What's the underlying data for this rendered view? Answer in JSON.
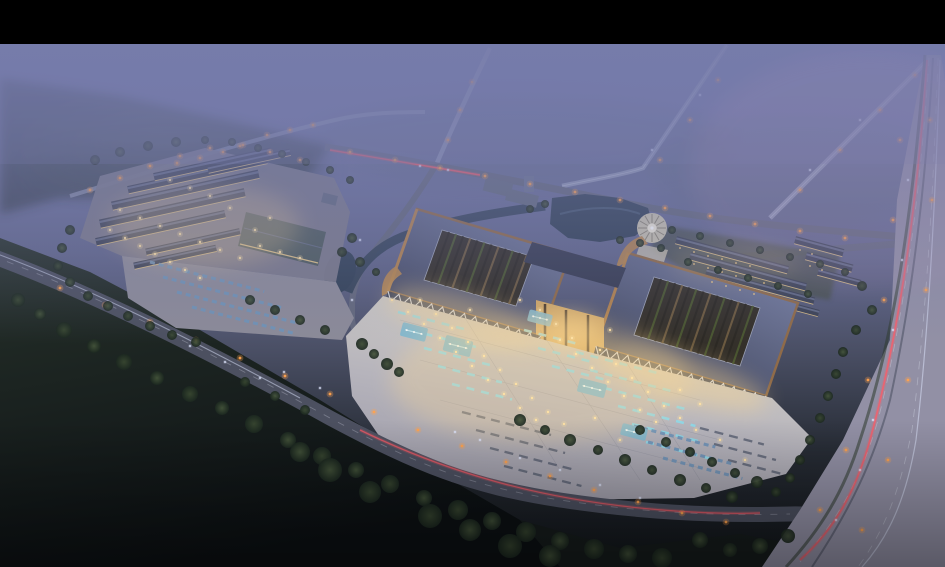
{
  "meta": {
    "alt": "Twilight aerial rendering of a lakeside commercial complex: two grand curved-roof halls with open courtyards, an illuminated forecourt plaza with cyan-lit lanes and fountain pools, a secondary market complex with parking, ponds, a circular plaza, rows of low buildings, tree lines, and roads with car light trails fading into purple mist.",
    "canvas": {
      "w": 945,
      "h": 567
    },
    "letterbox_top": 44
  },
  "colors": {
    "black_bar": "#000000",
    "sky_top": "#7379a9",
    "sky_upper": "#6f74a0",
    "sky_mid": "#61668a",
    "ground_mid": "#4b5066",
    "ground_low": "#272c35",
    "ground_bottom": "#111519",
    "mist": "#767cab",
    "mist_pink": "#b193b8",
    "forest_tl": "#3c4653",
    "forest_patch": "#4a5a52",
    "field_dark_top": "#27322b",
    "field_dark_bottom": "#0c1013",
    "tree_core": "#44543a",
    "tree_core2": "#394831",
    "tree_edge": "#1c2820",
    "road_main": "#4c5060",
    "road_minor": "#63687c",
    "road_far": "#9aa0bc",
    "highway": "#8c8ea2",
    "highway_tint": "#a79bb0",
    "lane_white": "#d8dce8",
    "median": "#5f6274",
    "trail_red": "#ff5a66",
    "trail_white": "#dfe7ff",
    "light_warm": "#ffe2a4",
    "light_street": "#ffa24e",
    "window_warm": "#f5cd85",
    "plaza_bright": "#d6d2c7",
    "plaza_mid": "#b6b4bc",
    "plaza_far": "#9a98a6",
    "pool": "#7fb7cf",
    "pool_light": "#c9eef8",
    "cyan_row": "#8fd8e8",
    "row_dark": "#5a6173",
    "car_blue": "#6f93b8",
    "roof_dark": "#383d53",
    "roof_light": "#767ea0",
    "copper": "#8f6b49",
    "copper_light": "#b5854f",
    "courtyard_base": "#34302a",
    "beam": "#6e5c41",
    "beam_dark": "#2c2924",
    "court_green": "#4b5831",
    "colonnade_glass": "#2e3850",
    "truss": "#dde3ef",
    "colonnade_lit": "#e9c98a",
    "gate_warm": "#d2a968",
    "gate_frame": "#4b3b2b",
    "water": "#334257",
    "water_hi": "#51657e",
    "platform": "#7b7a8a",
    "lot": "#8b8a98",
    "smallroof": "#3d4356",
    "smallroof_ridge": "#6b7390",
    "bighall": "#4f5c5e",
    "circle_fill": "#c7c1ae",
    "circle_spoke": "#8d8776",
    "circle_center": "#efe9d8",
    "lawn": "#3f4936",
    "hedge": "#36422e",
    "glow_warm": "#ffd98f",
    "verge_green": "#2e3b2e",
    "office_gray": "#636a7e"
  },
  "scene": {
    "halls": [
      {
        "roof": "388,291 541,336 570,254 417,209",
        "courtyard": "424,280 516,306 534,257 442,230",
        "stripes": 13
      },
      {
        "roof": "596,346 766,396 798,303 628,253",
        "courtyard": "634,335 740,366 760,308 654,277",
        "stripes": 15
      }
    ],
    "colonnades": [
      {
        "x1": 388,
        "y1": 291,
        "x2": 541,
        "y2": 336
      },
      {
        "x1": 596,
        "y1": 346,
        "x2": 766,
        "y2": 396
      }
    ],
    "roof_strips": [
      [
        96,
        242,
        132,
        8,
        0
      ],
      [
        100,
        224,
        148,
        9,
        0
      ],
      [
        112,
        206,
        150,
        9,
        0
      ],
      [
        128,
        190,
        142,
        8,
        0
      ],
      [
        154,
        177,
        120,
        8,
        0
      ],
      [
        208,
        170,
        84,
        7,
        0
      ],
      [
        146,
        252,
        96,
        7,
        0
      ],
      [
        134,
        266,
        84,
        7,
        0
      ],
      [
        676,
        240,
        116,
        8,
        1
      ],
      [
        690,
        256,
        120,
        8,
        1
      ],
      [
        706,
        272,
        112,
        7,
        1
      ],
      [
        724,
        288,
        98,
        7,
        1
      ],
      [
        795,
        240,
        50,
        8,
        1
      ],
      [
        806,
        256,
        48,
        8,
        1
      ],
      [
        818,
        272,
        44,
        7,
        1
      ]
    ],
    "rows": [
      [
        398,
        312,
        72,
        "cyan"
      ],
      [
        410,
        330,
        72,
        "cyan"
      ],
      [
        424,
        348,
        70,
        "cyan"
      ],
      [
        438,
        366,
        66,
        "cyan"
      ],
      [
        452,
        384,
        62,
        "cyan"
      ],
      [
        524,
        330,
        58,
        "cyan"
      ],
      [
        538,
        348,
        58,
        "cyan"
      ],
      [
        552,
        366,
        56,
        "cyan"
      ],
      [
        576,
        352,
        86,
        "cyan"
      ],
      [
        590,
        370,
        86,
        "cyan"
      ],
      [
        604,
        388,
        84,
        "cyan"
      ],
      [
        618,
        406,
        80,
        "cyan"
      ],
      [
        632,
        424,
        74,
        "cyan"
      ],
      [
        646,
        442,
        66,
        "cyan"
      ],
      [
        462,
        412,
        92,
        "dark"
      ],
      [
        476,
        430,
        92,
        "dark"
      ],
      [
        490,
        448,
        88,
        "dark"
      ],
      [
        504,
        466,
        80,
        "dark"
      ],
      [
        700,
        428,
        66,
        "dark"
      ],
      [
        714,
        444,
        64,
        "dark"
      ],
      [
        728,
        460,
        60,
        "dark"
      ],
      [
        634,
        426,
        84,
        "cars"
      ],
      [
        648,
        442,
        86,
        "cars"
      ],
      [
        663,
        458,
        82,
        "cars"
      ],
      [
        150,
        262,
        118,
        "cars"
      ],
      [
        163,
        277,
        126,
        "cars"
      ],
      [
        177,
        292,
        122,
        "cars"
      ],
      [
        192,
        307,
        108,
        "cars"
      ]
    ],
    "pools": [
      [
        414,
        332,
        26,
        14
      ],
      [
        458,
        346,
        28,
        16
      ],
      [
        540,
        318,
        24,
        12
      ],
      [
        592,
        388,
        28,
        14
      ],
      [
        634,
        432,
        26,
        12
      ]
    ],
    "trees": [
      [
        18,
        300,
        7
      ],
      [
        40,
        314,
        6
      ],
      [
        64,
        330,
        8
      ],
      [
        94,
        346,
        7
      ],
      [
        124,
        362,
        8
      ],
      [
        157,
        378,
        7
      ],
      [
        190,
        394,
        8
      ],
      [
        222,
        408,
        7
      ],
      [
        254,
        424,
        9
      ],
      [
        288,
        440,
        8
      ],
      [
        322,
        456,
        9
      ],
      [
        356,
        470,
        8
      ],
      [
        390,
        484,
        9
      ],
      [
        424,
        498,
        8
      ],
      [
        458,
        510,
        10
      ],
      [
        492,
        521,
        9
      ],
      [
        526,
        532,
        10
      ],
      [
        560,
        541,
        9
      ],
      [
        594,
        549,
        10
      ],
      [
        628,
        554,
        9
      ],
      [
        662,
        558,
        10
      ],
      [
        330,
        470,
        12
      ],
      [
        370,
        492,
        11
      ],
      [
        300,
        452,
        10
      ],
      [
        430,
        516,
        12
      ],
      [
        470,
        530,
        11
      ],
      [
        510,
        546,
        12
      ],
      [
        550,
        556,
        11
      ],
      [
        245,
        382,
        5
      ],
      [
        275,
        396,
        5
      ],
      [
        305,
        410,
        5
      ],
      [
        520,
        420,
        6
      ],
      [
        545,
        430,
        5
      ],
      [
        570,
        440,
        6
      ],
      [
        598,
        450,
        5
      ],
      [
        625,
        460,
        6
      ],
      [
        652,
        470,
        5
      ],
      [
        680,
        480,
        6
      ],
      [
        706,
        488,
        5
      ],
      [
        732,
        497,
        6
      ],
      [
        362,
        344,
        6
      ],
      [
        374,
        354,
        5
      ],
      [
        387,
        364,
        6
      ],
      [
        399,
        372,
        5
      ],
      [
        640,
        430,
        5
      ],
      [
        666,
        442,
        5
      ],
      [
        690,
        452,
        5
      ],
      [
        712,
        462,
        5
      ],
      [
        735,
        473,
        5
      ],
      [
        757,
        482,
        6
      ],
      [
        776,
        492,
        5
      ],
      [
        352,
        238,
        5
      ],
      [
        342,
        252,
        5
      ],
      [
        360,
        262,
        5
      ],
      [
        376,
        272,
        4
      ],
      [
        545,
        204,
        4
      ],
      [
        530,
        209,
        4
      ],
      [
        640,
        243,
        4
      ],
      [
        661,
        248,
        4
      ],
      [
        620,
        240,
        4
      ],
      [
        672,
        230,
        4
      ],
      [
        700,
        236,
        4
      ],
      [
        730,
        243,
        4
      ],
      [
        760,
        250,
        4
      ],
      [
        790,
        257,
        4
      ],
      [
        820,
        264,
        4
      ],
      [
        845,
        272,
        4
      ],
      [
        688,
        262,
        4
      ],
      [
        718,
        270,
        4
      ],
      [
        748,
        278,
        4
      ],
      [
        778,
        286,
        4
      ],
      [
        808,
        294,
        4
      ],
      [
        862,
        286,
        5
      ],
      [
        872,
        310,
        5
      ],
      [
        856,
        330,
        5
      ],
      [
        843,
        352,
        5
      ],
      [
        836,
        374,
        5
      ],
      [
        828,
        396,
        5
      ],
      [
        820,
        418,
        5
      ],
      [
        810,
        440,
        5
      ],
      [
        800,
        460,
        5
      ],
      [
        790,
        478,
        5
      ],
      [
        70,
        230,
        5
      ],
      [
        62,
        248,
        5
      ],
      [
        58,
        266,
        5
      ],
      [
        70,
        282,
        5
      ],
      [
        88,
        296,
        5
      ],
      [
        108,
        306,
        5
      ],
      [
        128,
        316,
        5
      ],
      [
        150,
        326,
        5
      ],
      [
        172,
        335,
        5
      ],
      [
        196,
        342,
        5
      ],
      [
        95,
        160,
        5
      ],
      [
        120,
        152,
        5
      ],
      [
        148,
        146,
        5
      ],
      [
        176,
        142,
        5
      ],
      [
        205,
        140,
        4
      ],
      [
        232,
        142,
        4
      ],
      [
        258,
        148,
        4
      ],
      [
        282,
        154,
        4
      ],
      [
        306,
        162,
        4
      ],
      [
        330,
        170,
        4
      ],
      [
        350,
        180,
        4
      ],
      [
        250,
        300,
        5
      ],
      [
        275,
        310,
        5
      ],
      [
        300,
        320,
        5
      ],
      [
        325,
        330,
        5
      ],
      [
        700,
        540,
        8
      ],
      [
        730,
        550,
        7
      ],
      [
        760,
        546,
        8
      ],
      [
        788,
        536,
        7
      ]
    ],
    "street_lights": [
      [
        60,
        288
      ],
      [
        105,
        305
      ],
      [
        150,
        322
      ],
      [
        196,
        340
      ],
      [
        240,
        358
      ],
      [
        285,
        376
      ],
      [
        330,
        394
      ],
      [
        374,
        412
      ],
      [
        418,
        430
      ],
      [
        462,
        446
      ],
      [
        506,
        462
      ],
      [
        550,
        476
      ],
      [
        594,
        490
      ],
      [
        638,
        502
      ],
      [
        682,
        513
      ],
      [
        726,
        522
      ],
      [
        350,
        152
      ],
      [
        395,
        160
      ],
      [
        440,
        168
      ],
      [
        485,
        176
      ],
      [
        530,
        184
      ],
      [
        575,
        192
      ],
      [
        620,
        200
      ],
      [
        665,
        208
      ],
      [
        710,
        216
      ],
      [
        755,
        224
      ],
      [
        800,
        231
      ],
      [
        845,
        238
      ],
      [
        660,
        160
      ],
      [
        690,
        120
      ],
      [
        718,
        80
      ],
      [
        800,
        190
      ],
      [
        840,
        150
      ],
      [
        880,
        110
      ],
      [
        915,
        75
      ],
      [
        448,
        140
      ],
      [
        460,
        110
      ],
      [
        472,
        82
      ],
      [
        900,
        140
      ],
      [
        893,
        220
      ],
      [
        884,
        300
      ],
      [
        868,
        380
      ],
      [
        846,
        450
      ],
      [
        820,
        510
      ],
      [
        930,
        120
      ],
      [
        932,
        200
      ],
      [
        926,
        290
      ],
      [
        908,
        380
      ],
      [
        888,
        460
      ],
      [
        862,
        530
      ],
      [
        90,
        190
      ],
      [
        120,
        178
      ],
      [
        150,
        166
      ],
      [
        180,
        156
      ],
      [
        210,
        148
      ],
      [
        240,
        146
      ],
      [
        270,
        152
      ],
      [
        300,
        160
      ],
      [
        177,
        163
      ],
      [
        200,
        158
      ],
      [
        223,
        152
      ],
      [
        243,
        145
      ],
      [
        267,
        135
      ],
      [
        290,
        130
      ],
      [
        313,
        125
      ]
    ],
    "plaza_lights": [
      [
        392,
        300
      ],
      [
        408,
        312
      ],
      [
        424,
        324
      ],
      [
        440,
        338
      ],
      [
        456,
        352
      ],
      [
        472,
        366
      ],
      [
        488,
        380
      ],
      [
        504,
        394
      ],
      [
        520,
        408
      ],
      [
        536,
        420
      ],
      [
        420,
        300
      ],
      [
        436,
        314
      ],
      [
        452,
        328
      ],
      [
        468,
        342
      ],
      [
        484,
        356
      ],
      [
        500,
        370
      ],
      [
        516,
        384
      ],
      [
        532,
        398
      ],
      [
        548,
        412
      ],
      [
        564,
        424
      ],
      [
        560,
        340
      ],
      [
        576,
        354
      ],
      [
        592,
        368
      ],
      [
        608,
        382
      ],
      [
        624,
        396
      ],
      [
        640,
        410
      ],
      [
        656,
        422
      ],
      [
        600,
        350
      ],
      [
        616,
        364
      ],
      [
        632,
        378
      ],
      [
        648,
        392
      ],
      [
        664,
        406
      ],
      [
        680,
        418
      ],
      [
        696,
        430
      ],
      [
        540,
        310
      ],
      [
        556,
        324
      ],
      [
        572,
        338
      ],
      [
        470,
        310
      ],
      [
        595,
        418
      ],
      [
        620,
        440
      ],
      [
        520,
        300
      ],
      [
        610,
        330
      ],
      [
        680,
        390
      ],
      [
        700,
        404
      ],
      [
        720,
        440
      ],
      [
        745,
        460
      ]
    ],
    "complex_lights": [
      [
        110,
        230
      ],
      [
        125,
        238
      ],
      [
        140,
        246
      ],
      [
        155,
        254
      ],
      [
        170,
        262
      ],
      [
        185,
        270
      ],
      [
        200,
        278
      ],
      [
        120,
        210
      ],
      [
        140,
        218
      ],
      [
        160,
        226
      ],
      [
        180,
        234
      ],
      [
        200,
        242
      ],
      [
        220,
        250
      ],
      [
        240,
        258
      ],
      [
        260,
        246
      ],
      [
        280,
        252
      ],
      [
        300,
        258
      ],
      [
        255,
        230
      ],
      [
        270,
        218
      ],
      [
        230,
        208
      ],
      [
        210,
        196
      ],
      [
        190,
        188
      ],
      [
        170,
        180
      ]
    ],
    "windows": [
      [
        680,
        248
      ],
      [
        694,
        252
      ],
      [
        708,
        256
      ],
      [
        722,
        259
      ],
      [
        736,
        263
      ],
      [
        750,
        266
      ],
      [
        694,
        264
      ],
      [
        708,
        268
      ],
      [
        722,
        272
      ],
      [
        736,
        276
      ],
      [
        750,
        280
      ],
      [
        764,
        283
      ],
      [
        712,
        282
      ],
      [
        726,
        286
      ],
      [
        740,
        290
      ],
      [
        754,
        294
      ],
      [
        800,
        250
      ],
      [
        812,
        254
      ],
      [
        810,
        266
      ],
      [
        822,
        270
      ]
    ],
    "cars": [
      [
        420,
        166
      ],
      [
        448,
        170
      ],
      [
        360,
        240
      ],
      [
        352,
        300
      ],
      [
        455,
        432
      ],
      [
        480,
        440
      ],
      [
        520,
        458
      ],
      [
        560,
        470
      ],
      [
        600,
        485
      ],
      [
        640,
        498
      ],
      [
        190,
        346
      ],
      [
        225,
        362
      ],
      [
        260,
        378
      ],
      [
        320,
        388
      ],
      [
        284,
        372
      ],
      [
        908,
        180
      ],
      [
        902,
        260
      ],
      [
        893,
        330
      ],
      [
        873,
        420
      ],
      [
        860,
        470
      ],
      [
        836,
        520
      ],
      [
        652,
        150
      ],
      [
        700,
        95
      ],
      [
        810,
        170
      ],
      [
        860,
        120
      ]
    ]
  }
}
